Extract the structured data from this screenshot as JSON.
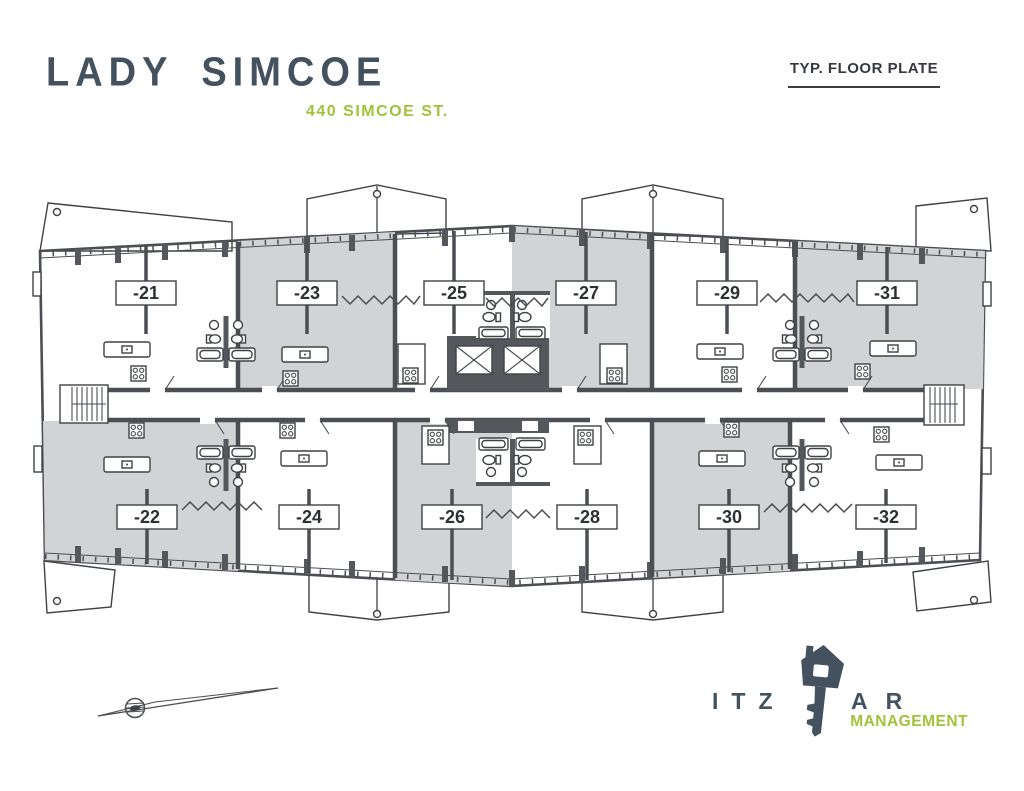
{
  "header": {
    "title": "LADY SIMCOE",
    "address": "440 SIMCOE ST.",
    "plate_label": "TYP. FLOOR PLATE"
  },
  "floorplan": {
    "units_top": [
      "-21",
      "-23",
      "-25",
      "-27",
      "-29",
      "-31"
    ],
    "units_bottom": [
      "-22",
      "-24",
      "-26",
      "-28",
      "-30",
      "-32"
    ],
    "icons": {
      "compass": "north-arrow-icon",
      "elevator": "elevator-x-icon",
      "stairs": "stair-treads-icon"
    }
  },
  "logo": {
    "wordmark_left": "ITZ",
    "wordmark_right": "AR",
    "subtitle": "MANAGEMENT",
    "icon": "key-house-icon"
  },
  "colors": {
    "brand_slate": "#43525e",
    "accent_green": "#a3c139",
    "plan_line": "#4b4e52",
    "plan_wall_fill": "#54575b",
    "unit_fill_gray": "#d2d3d5",
    "label_text": "#2d3033"
  }
}
